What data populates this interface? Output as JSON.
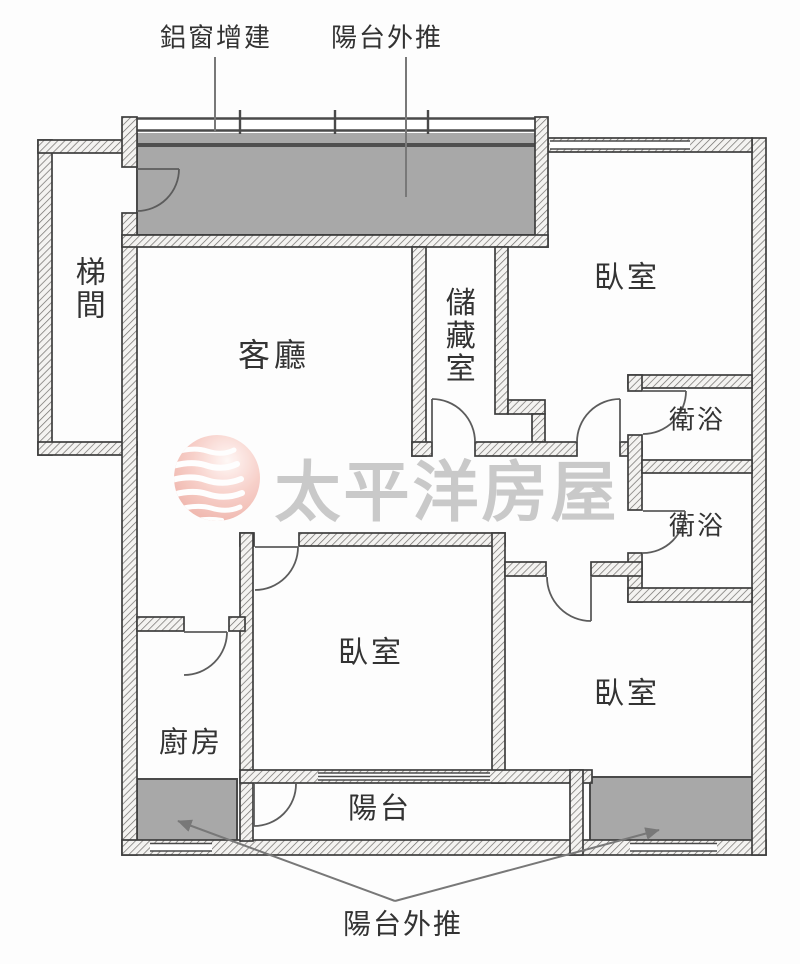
{
  "plan": {
    "annotations": {
      "aluminum_window_addition": "鋁窗增建",
      "balcony_pushout_top": "陽台外推",
      "balcony_pushout_bottom": "陽台外推"
    },
    "rooms": {
      "stairwell": "梯間",
      "living_room": "客廳",
      "storage_room": "儲藏室",
      "bedroom_top_right": "臥室",
      "bedroom_middle": "臥室",
      "bedroom_bottom_right": "臥室",
      "bathroom_upper": "衛浴",
      "bathroom_lower": "衛浴",
      "kitchen": "廚房",
      "balcony": "陽台"
    },
    "watermark": {
      "brand_name": "太平洋房屋"
    },
    "colors": {
      "shaded_area": "#a8a8a8",
      "wall_line": "#3e3e3e",
      "label_text": "#333333",
      "leader_line": "#787878",
      "watermark_text": "#c7c7c7",
      "watermark_sphere": "#f0afa5",
      "window_line": "#4a4a4a"
    }
  }
}
